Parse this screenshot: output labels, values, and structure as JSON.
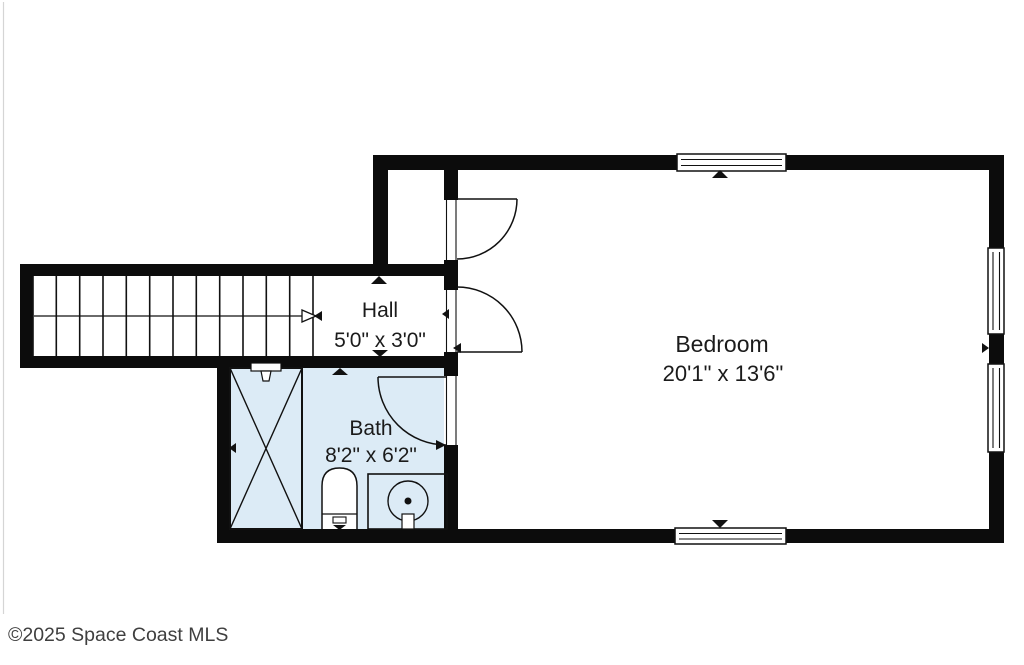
{
  "floorplan": {
    "watermark": "©2025 Space Coast MLS",
    "rooms": {
      "hall": {
        "name": "Hall",
        "dimensions": "5'0\" x 3'0\""
      },
      "bedroom": {
        "name": "Bedroom",
        "dimensions": "20'1\" x 13'6\""
      },
      "bath": {
        "name": "Bath",
        "dimensions": "8'2\" x 6'2\""
      }
    },
    "features": [
      "stairs",
      "closet",
      "shower",
      "toilet",
      "sink-vanity",
      "windows",
      "doors"
    ],
    "colors": {
      "wall": "#0c0c0c",
      "bath_floor": "#dcebf6",
      "room_floor": "#ffffff",
      "label_text": "#1b1b1b",
      "watermark_text": "#3f3f3f"
    }
  }
}
